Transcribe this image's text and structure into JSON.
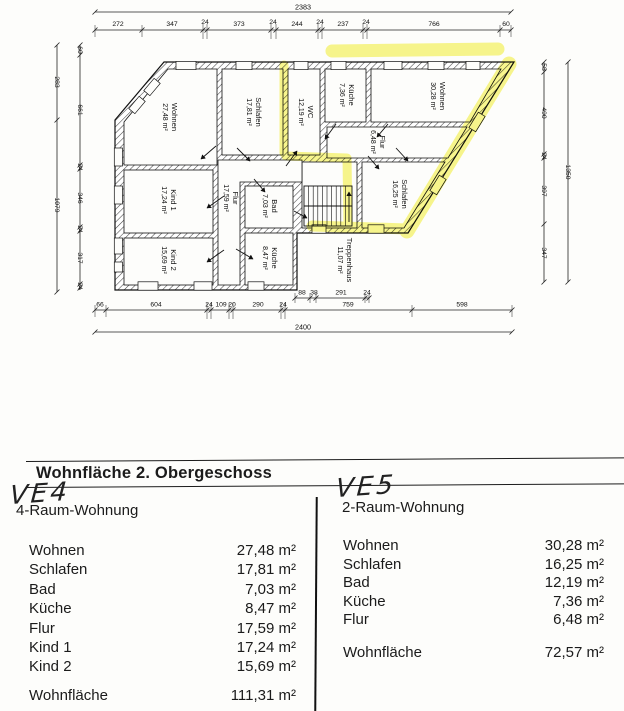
{
  "plan": {
    "highlight_color": "#f2ee2e",
    "dims": {
      "top_total": "2383",
      "top": [
        "272",
        "347",
        "24",
        "373",
        "24",
        "244",
        "24",
        "237",
        "24",
        "766",
        "60"
      ],
      "bottom": [
        "66",
        "604",
        "24",
        "109",
        "20",
        "290",
        "24",
        "759",
        "598"
      ],
      "bottom_total": "2400",
      "stair": [
        "88",
        "38",
        "291",
        "24"
      ],
      "left_outer": [
        "283",
        "1079"
      ],
      "left_inner": [
        "60",
        "661",
        "24",
        "346",
        "24",
        "317",
        "24"
      ],
      "right_inner": [
        "58",
        "490",
        "24",
        "397",
        "347"
      ],
      "right_outer": "1350"
    },
    "rooms": [
      {
        "name": "Wohnen",
        "area": "27,48 m²"
      },
      {
        "name": "Schlafen",
        "area": "17,81 m²"
      },
      {
        "name": "WC",
        "area": "12,19 m²"
      },
      {
        "name": "Küche",
        "area": "7,36 m²"
      },
      {
        "name": "Wohnen",
        "area": "30,28 m²"
      },
      {
        "name": "Flur",
        "area": "6,48 m²"
      },
      {
        "name": "Schlafen",
        "area": "16,25 m²"
      },
      {
        "name": "Treppenhaus",
        "area": "11,07 m²"
      },
      {
        "name": "Flur",
        "area": "17,59 m²"
      },
      {
        "name": "Kind 1",
        "area": "17,24 m²"
      },
      {
        "name": "Bad",
        "area": "7,03 m²"
      },
      {
        "name": "Kind 2",
        "area": "15,69 m²"
      },
      {
        "name": "Küche",
        "area": "8,47 m²"
      }
    ]
  },
  "table": {
    "title": "Wohnfläche 2. Obergeschoss",
    "left": {
      "handwritten": "VE4",
      "subtitle": "4-Raum-Wohnung",
      "rows": [
        {
          "label": "Wohnen",
          "value": "27,48 m²"
        },
        {
          "label": "Schlafen",
          "value": "17,81 m²"
        },
        {
          "label": "Bad",
          "value": "7,03 m²"
        },
        {
          "label": "Küche",
          "value": "8,47 m²"
        },
        {
          "label": "Flur",
          "value": "17,59 m²"
        },
        {
          "label": "Kind 1",
          "value": "17,24 m²"
        },
        {
          "label": "Kind 2",
          "value": "15,69 m²"
        }
      ],
      "total_label": "Wohnfläche",
      "total_value": "111,31 m²"
    },
    "right": {
      "handwritten": "VE5",
      "subtitle": "2-Raum-Wohnung",
      "rows": [
        {
          "label": "Wohnen",
          "value": "30,28 m²"
        },
        {
          "label": "Schlafen",
          "value": "16,25 m²"
        },
        {
          "label": "Bad",
          "value": "12,19 m²"
        },
        {
          "label": "Küche",
          "value": "7,36 m²"
        },
        {
          "label": "Flur",
          "value": "6,48 m²"
        }
      ],
      "total_label": "Wohnfläche",
      "total_value": "72,57 m²"
    }
  }
}
